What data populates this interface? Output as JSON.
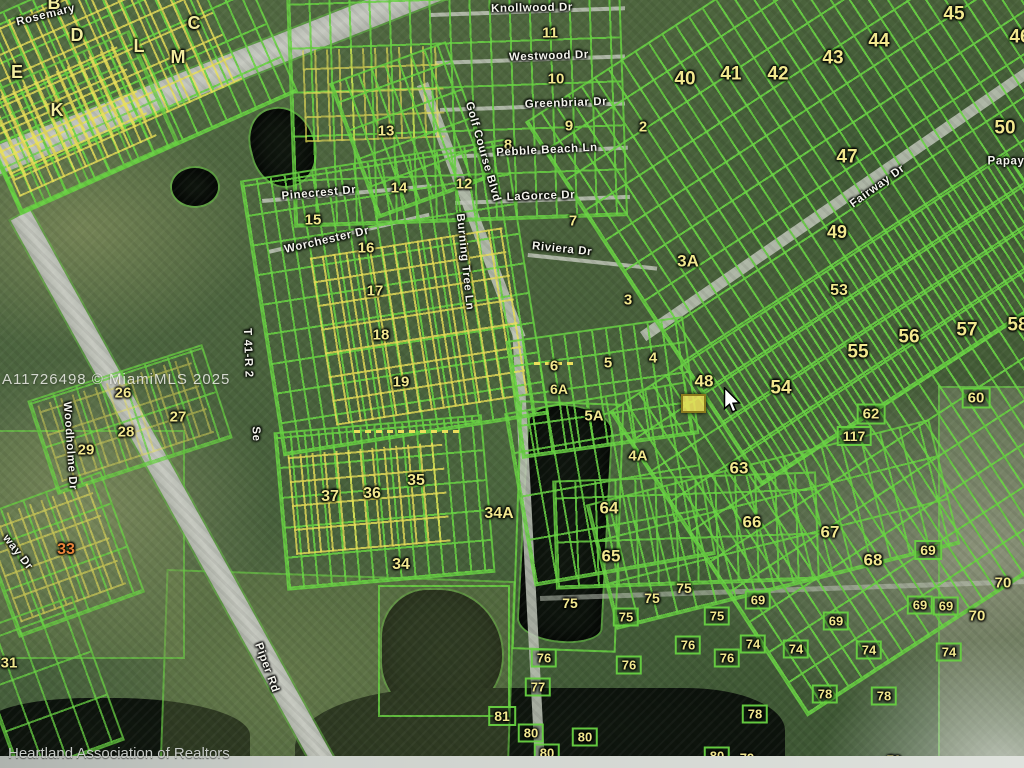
{
  "meta": {
    "watermark": "A11726498 © MiamiMLS 2025",
    "credit": "Heartland Association of Realtors"
  },
  "colors": {
    "parcel_line_green": "#68d242",
    "parcel_line_yellow": "#e9e056",
    "number_label": "#f2e88e",
    "street_label": "#f4f4ec",
    "alert_number": "#e8833a",
    "road_gray": "#bfc3b9",
    "water_dark": "#0d130d",
    "highlight_fill": "#eee05c"
  },
  "street_labels": [
    {
      "t": "Knollwood Dr",
      "x": 532,
      "y": 9,
      "r": -1
    },
    {
      "t": "Westwood Dr",
      "x": 549,
      "y": 57,
      "r": -2
    },
    {
      "t": "Greenbriar Dr",
      "x": 566,
      "y": 104,
      "r": -2
    },
    {
      "t": "Pebble Beach Ln",
      "x": 547,
      "y": 151,
      "r": -3
    },
    {
      "t": "LaGorce Dr",
      "x": 541,
      "y": 197,
      "r": -2
    },
    {
      "t": "Riviera Dr",
      "x": 562,
      "y": 250,
      "r": 6
    },
    {
      "t": "Golf Course Blvd",
      "x": 482,
      "y": 152,
      "r": 74
    },
    {
      "t": "Burning Tree Ln",
      "x": 464,
      "y": 262,
      "r": 84
    },
    {
      "t": "Pinecrest Dr",
      "x": 319,
      "y": 194,
      "r": -5
    },
    {
      "t": "Worchester Dr",
      "x": 327,
      "y": 241,
      "r": -13
    },
    {
      "t": "Fairway Dr",
      "x": 878,
      "y": 187,
      "r": -36
    },
    {
      "t": "Papay",
      "x": 1006,
      "y": 162,
      "r": 0
    },
    {
      "t": "Rosemary",
      "x": 46,
      "y": 16,
      "r": -14
    },
    {
      "t": "Woodholme Dr",
      "x": 69,
      "y": 446,
      "r": 86
    },
    {
      "t": "way Dr",
      "x": 17,
      "y": 553,
      "r": 52
    },
    {
      "t": "Piper Rd",
      "x": 266,
      "y": 668,
      "r": 70
    }
  ],
  "survey_labels": [
    {
      "t": "T 41-R 2",
      "x": 247,
      "y": 353,
      "r": 88
    },
    {
      "t": "Se",
      "x": 255,
      "y": 434,
      "r": 88
    }
  ],
  "block_letters": [
    {
      "t": "B",
      "x": 54,
      "y": 3
    },
    {
      "t": "D",
      "x": 77,
      "y": 35
    },
    {
      "t": "L",
      "x": 139,
      "y": 46
    },
    {
      "t": "C",
      "x": 194,
      "y": 23
    },
    {
      "t": "M",
      "x": 178,
      "y": 57
    },
    {
      "t": "E",
      "x": 17,
      "y": 72
    },
    {
      "t": "K",
      "x": 57,
      "y": 110
    }
  ],
  "section_labels": [
    {
      "t": "11",
      "x": 550,
      "y": 33
    },
    {
      "t": "10",
      "x": 556,
      "y": 79
    },
    {
      "t": "9",
      "x": 569,
      "y": 126
    },
    {
      "t": "8",
      "x": 508,
      "y": 145
    },
    {
      "t": "2",
      "x": 643,
      "y": 127
    },
    {
      "t": "7",
      "x": 573,
      "y": 221
    },
    {
      "t": "12",
      "x": 464,
      "y": 184
    },
    {
      "t": "13",
      "x": 386,
      "y": 131
    },
    {
      "t": "14",
      "x": 399,
      "y": 188
    },
    {
      "t": "15",
      "x": 313,
      "y": 220
    },
    {
      "t": "16",
      "x": 366,
      "y": 248
    },
    {
      "t": "17",
      "x": 375,
      "y": 291
    },
    {
      "t": "18",
      "x": 381,
      "y": 335
    },
    {
      "t": "19",
      "x": 401,
      "y": 382
    },
    {
      "t": "3A",
      "x": 688,
      "y": 261,
      "s": 17
    },
    {
      "t": "3",
      "x": 628,
      "y": 300
    },
    {
      "t": "40",
      "x": 685,
      "y": 79,
      "s": 19
    },
    {
      "t": "41",
      "x": 731,
      "y": 74,
      "s": 19
    },
    {
      "t": "42",
      "x": 778,
      "y": 74,
      "s": 19
    },
    {
      "t": "43",
      "x": 833,
      "y": 58,
      "s": 19
    },
    {
      "t": "44",
      "x": 879,
      "y": 41,
      "s": 19
    },
    {
      "t": "45",
      "x": 954,
      "y": 14,
      "s": 19
    },
    {
      "t": "46",
      "x": 1020,
      "y": 37,
      "s": 19
    },
    {
      "t": "50",
      "x": 1005,
      "y": 128,
      "s": 19
    },
    {
      "t": "47",
      "x": 847,
      "y": 157,
      "s": 19
    },
    {
      "t": "49",
      "x": 837,
      "y": 232,
      "s": 18
    },
    {
      "t": "53",
      "x": 839,
      "y": 291,
      "s": 16
    },
    {
      "t": "55",
      "x": 858,
      "y": 352,
      "s": 19
    },
    {
      "t": "56",
      "x": 909,
      "y": 337,
      "s": 19
    },
    {
      "t": "57",
      "x": 967,
      "y": 330,
      "s": 19
    },
    {
      "t": "58",
      "x": 1018,
      "y": 325,
      "s": 19
    },
    {
      "t": "54",
      "x": 781,
      "y": 388,
      "s": 19
    },
    {
      "t": "48",
      "x": 704,
      "y": 381,
      "s": 17
    },
    {
      "t": "62",
      "x": 871,
      "y": 414,
      "s": 15,
      "b": true
    },
    {
      "t": "117",
      "x": 854,
      "y": 436,
      "s": 14,
      "b": true
    },
    {
      "t": "60",
      "x": 976,
      "y": 398,
      "s": 15,
      "b": true
    },
    {
      "t": "5",
      "x": 608,
      "y": 363
    },
    {
      "t": "4",
      "x": 653,
      "y": 358
    },
    {
      "t": "6",
      "x": 554,
      "y": 366
    },
    {
      "t": "6A",
      "x": 559,
      "y": 389,
      "s": 14
    },
    {
      "t": "5A",
      "x": 594,
      "y": 416,
      "s": 15
    },
    {
      "t": "4A",
      "x": 638,
      "y": 456,
      "s": 15
    },
    {
      "t": "63",
      "x": 739,
      "y": 468,
      "s": 17
    },
    {
      "t": "64",
      "x": 609,
      "y": 508,
      "s": 17
    },
    {
      "t": "65",
      "x": 611,
      "y": 556,
      "s": 17
    },
    {
      "t": "66",
      "x": 752,
      "y": 522,
      "s": 17
    },
    {
      "t": "67",
      "x": 830,
      "y": 532,
      "s": 17
    },
    {
      "t": "68",
      "x": 873,
      "y": 560,
      "s": 17
    },
    {
      "t": "69",
      "x": 928,
      "y": 550,
      "s": 14,
      "b": true
    },
    {
      "t": "70",
      "x": 1003,
      "y": 583,
      "s": 15
    },
    {
      "t": "69",
      "x": 946,
      "y": 606,
      "s": 13,
      "b": true
    },
    {
      "t": "70",
      "x": 977,
      "y": 616,
      "s": 15
    },
    {
      "t": "75",
      "x": 570,
      "y": 603,
      "s": 14
    },
    {
      "t": "75",
      "x": 652,
      "y": 598,
      "s": 14
    },
    {
      "t": "75",
      "x": 684,
      "y": 588,
      "s": 14
    },
    {
      "t": "75",
      "x": 626,
      "y": 617,
      "s": 13,
      "b": true
    },
    {
      "t": "75",
      "x": 717,
      "y": 616,
      "s": 13,
      "b": true
    },
    {
      "t": "69",
      "x": 758,
      "y": 600,
      "s": 13,
      "b": true
    },
    {
      "t": "69",
      "x": 836,
      "y": 621,
      "s": 13,
      "b": true
    },
    {
      "t": "69",
      "x": 920,
      "y": 605,
      "s": 13,
      "b": true
    },
    {
      "t": "76",
      "x": 544,
      "y": 658,
      "s": 13,
      "b": true
    },
    {
      "t": "76",
      "x": 629,
      "y": 665,
      "s": 13,
      "b": true
    },
    {
      "t": "76",
      "x": 688,
      "y": 645,
      "s": 13,
      "b": true
    },
    {
      "t": "76",
      "x": 727,
      "y": 658,
      "s": 13,
      "b": true
    },
    {
      "t": "74",
      "x": 753,
      "y": 644,
      "s": 13,
      "b": true
    },
    {
      "t": "74",
      "x": 796,
      "y": 649,
      "s": 13,
      "b": true
    },
    {
      "t": "74",
      "x": 869,
      "y": 650,
      "s": 13,
      "b": true
    },
    {
      "t": "74",
      "x": 949,
      "y": 652,
      "s": 13,
      "b": true
    },
    {
      "t": "77",
      "x": 538,
      "y": 687,
      "s": 13,
      "b": true
    },
    {
      "t": "78",
      "x": 755,
      "y": 714,
      "s": 13,
      "b": true
    },
    {
      "t": "78",
      "x": 825,
      "y": 694,
      "s": 13,
      "b": true
    },
    {
      "t": "78",
      "x": 884,
      "y": 696,
      "s": 13,
      "b": true
    },
    {
      "t": "81",
      "x": 502,
      "y": 716,
      "s": 14,
      "b": true
    },
    {
      "t": "80",
      "x": 531,
      "y": 733,
      "s": 13,
      "b": true
    },
    {
      "t": "80",
      "x": 585,
      "y": 737,
      "s": 13,
      "b": true
    },
    {
      "t": "80",
      "x": 547,
      "y": 753,
      "s": 13,
      "b": true
    },
    {
      "t": "80",
      "x": 717,
      "y": 756,
      "s": 13,
      "b": true
    },
    {
      "t": "79",
      "x": 747,
      "y": 758,
      "s": 13
    },
    {
      "t": "79",
      "x": 894,
      "y": 760,
      "s": 13
    },
    {
      "t": "26",
      "x": 123,
      "y": 393
    },
    {
      "t": "27",
      "x": 178,
      "y": 417
    },
    {
      "t": "28",
      "x": 126,
      "y": 432
    },
    {
      "t": "29",
      "x": 86,
      "y": 450
    },
    {
      "t": "33",
      "x": 66,
      "y": 550,
      "s": 16,
      "c": "#e8833a"
    },
    {
      "t": "31",
      "x": 9,
      "y": 663,
      "s": 15
    },
    {
      "t": "34",
      "x": 401,
      "y": 565,
      "s": 16
    },
    {
      "t": "35",
      "x": 416,
      "y": 481,
      "s": 16
    },
    {
      "t": "36",
      "x": 372,
      "y": 494,
      "s": 16
    },
    {
      "t": "37",
      "x": 330,
      "y": 497,
      "s": 16
    },
    {
      "t": "34A",
      "x": 499,
      "y": 514,
      "s": 16
    }
  ],
  "cursor": {
    "x": 723,
    "y": 387
  },
  "highlight_parcel": {
    "x": 681,
    "y": 394,
    "w": 21,
    "h": 15
  }
}
